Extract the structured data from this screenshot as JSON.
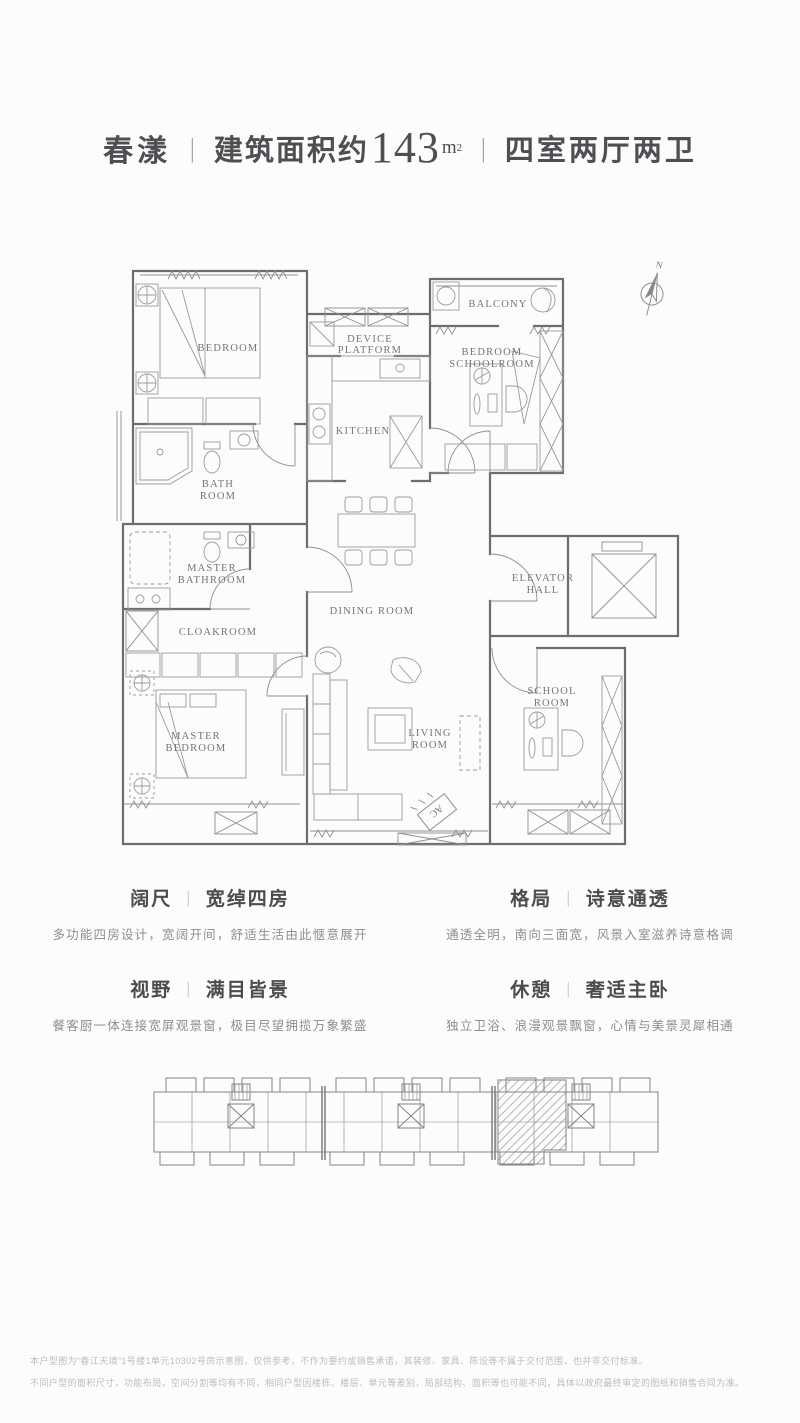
{
  "header": {
    "project_name": "春漾",
    "divider": "|",
    "area_label": "建筑面积约",
    "area_value": "143",
    "area_unit": "m",
    "area_unit_sup": "2",
    "layout_spec": "四室两厅两卫"
  },
  "floorplan": {
    "compass_label": "N",
    "ac_label": "AC",
    "labels": {
      "bedroom": "BEDROOM",
      "device_platform_1": "DEVICE",
      "device_platform_2": "PLATFORM",
      "balcony": "BALCONY",
      "bedroom_schoolroom_1": "BEDROOM",
      "bedroom_schoolroom_2": "SCHOOLROOM",
      "kitchen": "KITCHEN",
      "bath_room_1": "BATH",
      "bath_room_2": "ROOM",
      "master_bathroom_1": "MASTER",
      "master_bathroom_2": "BATHROOM",
      "cloakroom": "CLOAKROOM",
      "dining_room": "DINING ROOM",
      "elevator_hall_1": "ELEVATOR",
      "elevator_hall_2": "HALL",
      "master_bedroom_1": "MASTER",
      "master_bedroom_2": "BEDROOM",
      "living_room_1": "LIVING",
      "living_room_2": "ROOM",
      "school_room_1": "SCHOOL",
      "school_room_2": "ROOM"
    }
  },
  "features": [
    {
      "category": "阔尺",
      "divider": "|",
      "theme": "宽绰四房",
      "description": "多功能四房设计，宽阔开间，舒适生活由此惬意展开"
    },
    {
      "category": "格局",
      "divider": "|",
      "theme": "诗意通透",
      "description": "通透全明，南向三面宽，风景入室滋养诗意格调"
    },
    {
      "category": "视野",
      "divider": "|",
      "theme": "满目皆景",
      "description": "餐客厨一体连接宽屏观景窗，极目尽望拥揽万象繁盛"
    },
    {
      "category": "休憩",
      "divider": "|",
      "theme": "奢适主卧",
      "description": "独立卫浴、浪漫观景飘窗，心情与美景灵犀相通"
    }
  ],
  "disclaimer": {
    "line1": "本户型图为“春江天境”1号楼1单元10302号房示意图，仅供参考，不作为要约或销售承诺，其装修、家具、陈设等不属于交付范围，也并非交付标准。",
    "line2": "不同户型的面积尺寸，功能布局，空间分割等均有不同，相同户型因楼栋、楼层、单元等差别，局部结构、面积等也可能不同，具体以政府最终审定的图纸和销售合同为准。"
  }
}
